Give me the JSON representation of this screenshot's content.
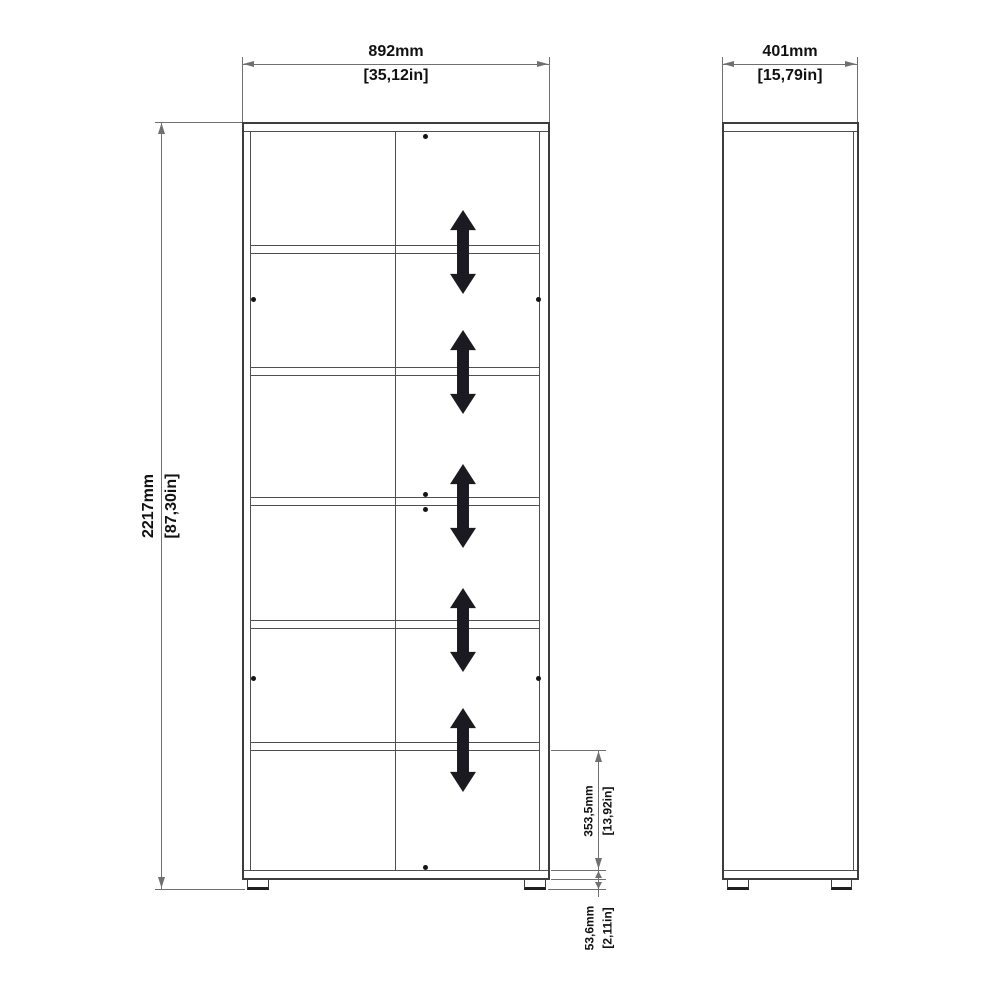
{
  "dimensions": {
    "width": {
      "mm": "892mm",
      "inches": "[35,12in]"
    },
    "depth": {
      "mm": "401mm",
      "inches": "[15,79in]"
    },
    "height": {
      "mm": "2217mm",
      "inches": "[87,30in]"
    },
    "shelf_spacing": {
      "mm": "353,5mm",
      "inches": "[13,92in]"
    },
    "base_height": {
      "mm": "53,6mm",
      "inches": "[2,11in]"
    }
  },
  "views": {
    "front": {
      "compartments": 6,
      "shelves": 5,
      "adjustable_shelf_arrows": 5,
      "fixing_dots": 8,
      "feet": 2
    },
    "side": {
      "feet": 2
    }
  },
  "icons": {
    "shelf_adjust_arrow": "double-vertical-arrow-icon",
    "fixing_dot": "dot-icon"
  },
  "colors": {
    "background": "#ffffff",
    "body_line": "#3d3d3d",
    "inner_line": "#4f4f4f",
    "dim_line": "#707070",
    "arrow_fill": "#1a1a20",
    "text": "#111111"
  }
}
